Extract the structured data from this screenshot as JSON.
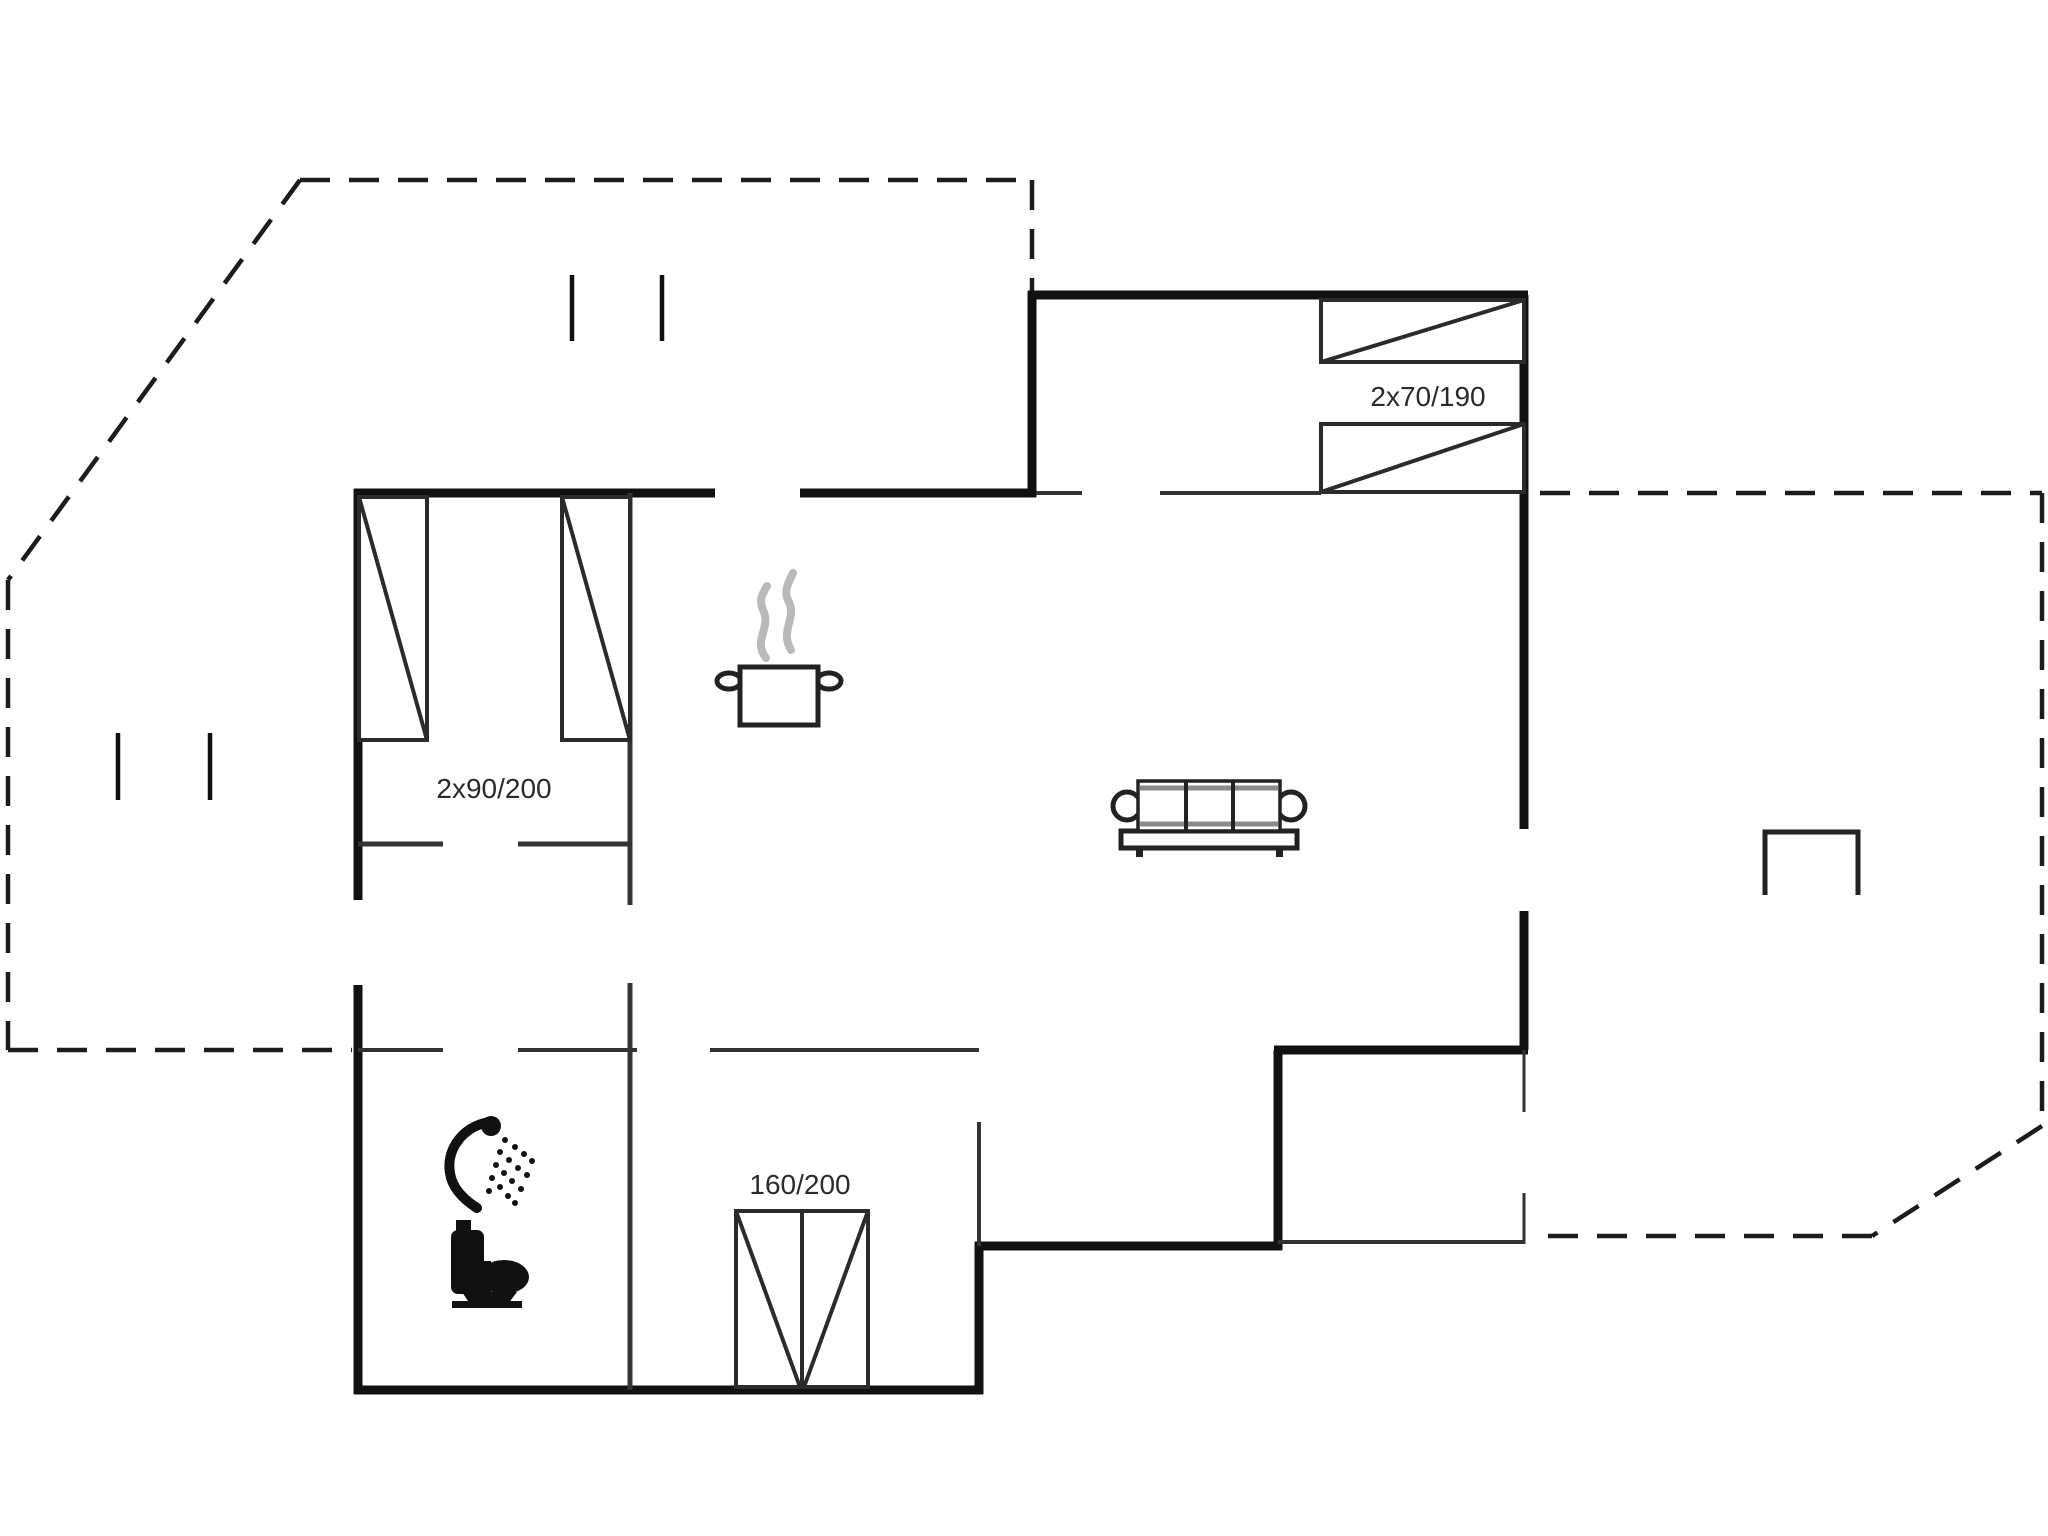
{
  "plan": {
    "type": "holiday-house-floor-plan",
    "labels": {
      "bunk_beds": "2x70/190",
      "twin_beds": "2x90/200",
      "double_bed": "160/200"
    },
    "colors": {
      "background": "#ffffff",
      "wall": "#111111",
      "partition": "#333333",
      "thin_line": "#4a4a4a",
      "boundary_dash": "#1c1c1c",
      "furniture_outline": "#222222",
      "furniture_fill": "#111111",
      "steam_gray": "#b9b9b9",
      "sofa_gray": "#8a8a8a"
    },
    "icons": [
      "cooking-pot-icon",
      "steam-icon",
      "sofa-icon",
      "shower-icon",
      "toilet-icon",
      "terrace-table-icon"
    ]
  }
}
